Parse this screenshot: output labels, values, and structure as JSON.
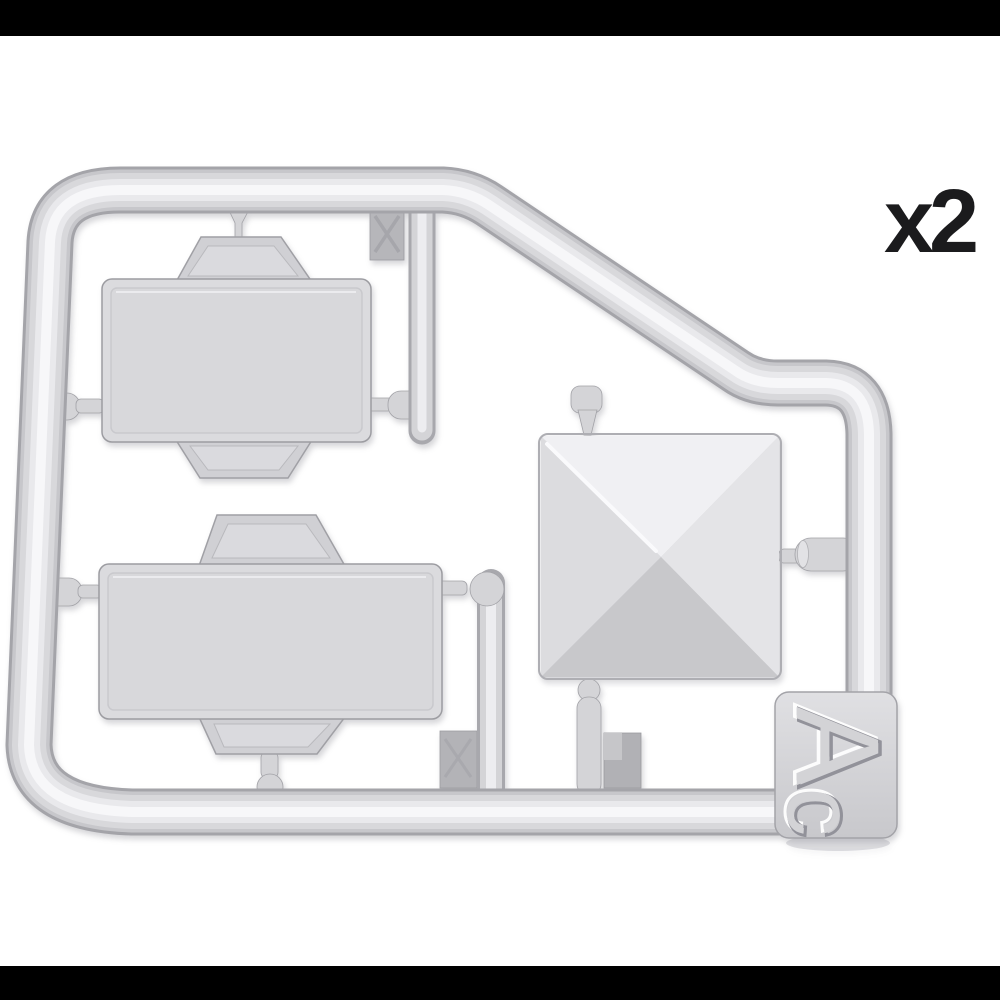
{
  "page": {
    "background_color": "#ffffff",
    "letterbox_color": "#000000"
  },
  "annotation": {
    "quantity_label": "x2",
    "text_color": "#1b1b1d"
  },
  "sprue": {
    "plastic_base_color": "#d2d2d5",
    "plastic_highlight_color": "#f6f6f8",
    "plastic_shadow_color": "#a4a4a9",
    "dark_tab_color": "#b3b3b7",
    "tag": {
      "letter_main": "A",
      "letter_sub": "c",
      "plate_color": "#d3d3d6"
    },
    "parts": [
      {
        "name": "folding-table-small"
      },
      {
        "name": "folding-table-large"
      },
      {
        "name": "pyramid-roof-panel"
      }
    ],
    "marks": [
      {
        "name": "x-mark-square-top"
      },
      {
        "name": "x-mark-tab-bottom"
      },
      {
        "name": "step-tab-bottom"
      }
    ]
  }
}
